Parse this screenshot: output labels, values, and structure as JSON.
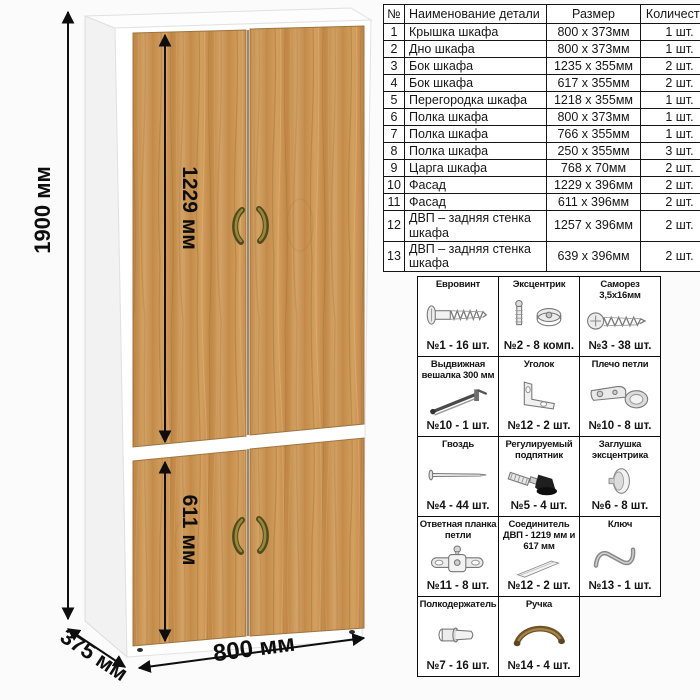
{
  "dimensions": {
    "height_label": "1900 мм",
    "upper_door_label": "1229 мм",
    "lower_door_label": "611 мм",
    "width_label": "800 мм",
    "depth_label": "375 мм"
  },
  "parts_table": {
    "headers": {
      "num": "№",
      "name": "Наименование детали",
      "size": "Размер",
      "qty": "Количество"
    },
    "rows": [
      {
        "num": "1",
        "name": "Крышка шкафа",
        "size": "800 х 373мм",
        "qty": "1 шт."
      },
      {
        "num": "2",
        "name": "Дно шкафа",
        "size": "800 х 373мм",
        "qty": "1 шт."
      },
      {
        "num": "3",
        "name": "Бок шкафа",
        "size": "1235 х 355мм",
        "qty": "2 шт."
      },
      {
        "num": "4",
        "name": "Бок шкафа",
        "size": "617 х 355мм",
        "qty": "2 шт."
      },
      {
        "num": "5",
        "name": "Перегородка шкафа",
        "size": "1218 х 355мм",
        "qty": "1 шт."
      },
      {
        "num": "6",
        "name": "Полка шкафа",
        "size": "800 х 373мм",
        "qty": "1 шт."
      },
      {
        "num": "7",
        "name": "Полка шкафа",
        "size": "766 х 355мм",
        "qty": "1 шт."
      },
      {
        "num": "8",
        "name": "Полка шкафа",
        "size": "250 х 355мм",
        "qty": "3 шт."
      },
      {
        "num": "9",
        "name": "Царга шкафа",
        "size": "768 х 70мм",
        "qty": "2 шт."
      },
      {
        "num": "10",
        "name": "Фасад",
        "size": "1229 х 396мм",
        "qty": "2 шт."
      },
      {
        "num": "11",
        "name": "Фасад",
        "size": "611 х 396мм",
        "qty": "2 шт."
      },
      {
        "num": "12",
        "name": "ДВП – задняя стенка шкафа",
        "size": "1257 х 396мм",
        "qty": "2 шт."
      },
      {
        "num": "13",
        "name": "ДВП – задняя стенка шкафа",
        "size": "639 х 396мм",
        "qty": "2 шт."
      }
    ]
  },
  "hardware": {
    "items": [
      {
        "label": "Евровинт",
        "count": "№1 - 16 шт.",
        "icon": "eurovint"
      },
      {
        "label": "Эксцентрик",
        "count": "№2 - 8 комп.",
        "icon": "eccentric"
      },
      {
        "label": "Саморез 3,5х16мм",
        "count": "№3 - 38 шт.",
        "icon": "samorez"
      },
      {
        "label": "Выдвижная вешалка 300 мм",
        "count": "№10 - 1 шт.",
        "icon": "hanger"
      },
      {
        "label": "Уголок",
        "count": "№12 - 2 шт.",
        "icon": "corner"
      },
      {
        "label": "Плечо петли",
        "count": "№10 - 8 шт.",
        "icon": "hinge-arm"
      },
      {
        "label": "Гвоздь",
        "count": "№4 - 44 шт.",
        "icon": "nail"
      },
      {
        "label": "Регулируемый подпятник",
        "count": "№5 - 4 шт.",
        "icon": "foot"
      },
      {
        "label": "Заглушка эксцентрика",
        "count": "№6 - 8 шт.",
        "icon": "cap"
      },
      {
        "label": "Ответная планка петли",
        "count": "№11 - 8 шт.",
        "icon": "hinge-plate"
      },
      {
        "label": "Соединитель ДВП - 1219 мм и 617 мм",
        "count": "№12 - 2 шт.",
        "icon": "hdf-connector"
      },
      {
        "label": "Ключ",
        "count": "№13 - 1 шт.",
        "icon": "key"
      },
      {
        "label": "Полкодержатель",
        "count": "№7 - 16 шт.",
        "icon": "shelf-pin"
      },
      {
        "label": "Ручка",
        "count": "№14 - 4 шт.",
        "icon": "handle"
      }
    ]
  },
  "colors": {
    "wood_base": "#c99456",
    "wood_dark_streak": "#9a6c38",
    "wood_light_streak": "#dcb579",
    "handle": "#6e5527",
    "carcass": "#ffffff",
    "dimension_text": "#0e0e0e",
    "table_border": "#151515"
  }
}
